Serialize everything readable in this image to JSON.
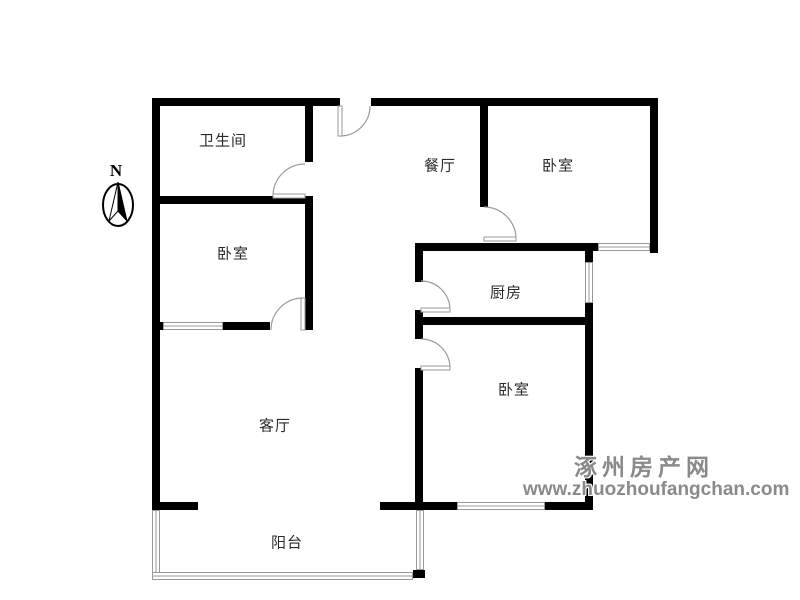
{
  "compass": {
    "north_label": "N"
  },
  "rooms": [
    {
      "label": "卫生间"
    },
    {
      "label": "餐厅"
    },
    {
      "label": "卧室"
    },
    {
      "label": "卧室"
    },
    {
      "label": "厨房"
    },
    {
      "label": "卧室"
    },
    {
      "label": "客厅"
    },
    {
      "label": "阳台"
    }
  ],
  "watermark": {
    "site_name": "涿州房产网",
    "site_url": "www.zhuozhoufangchan.com"
  },
  "colors": {
    "wall": "#000000",
    "window_line": "#999999",
    "door_line": "#9a9a9a",
    "watermark_text": "#8a8a8a",
    "label_text": "#2b2b2b",
    "background": "#ffffff"
  }
}
